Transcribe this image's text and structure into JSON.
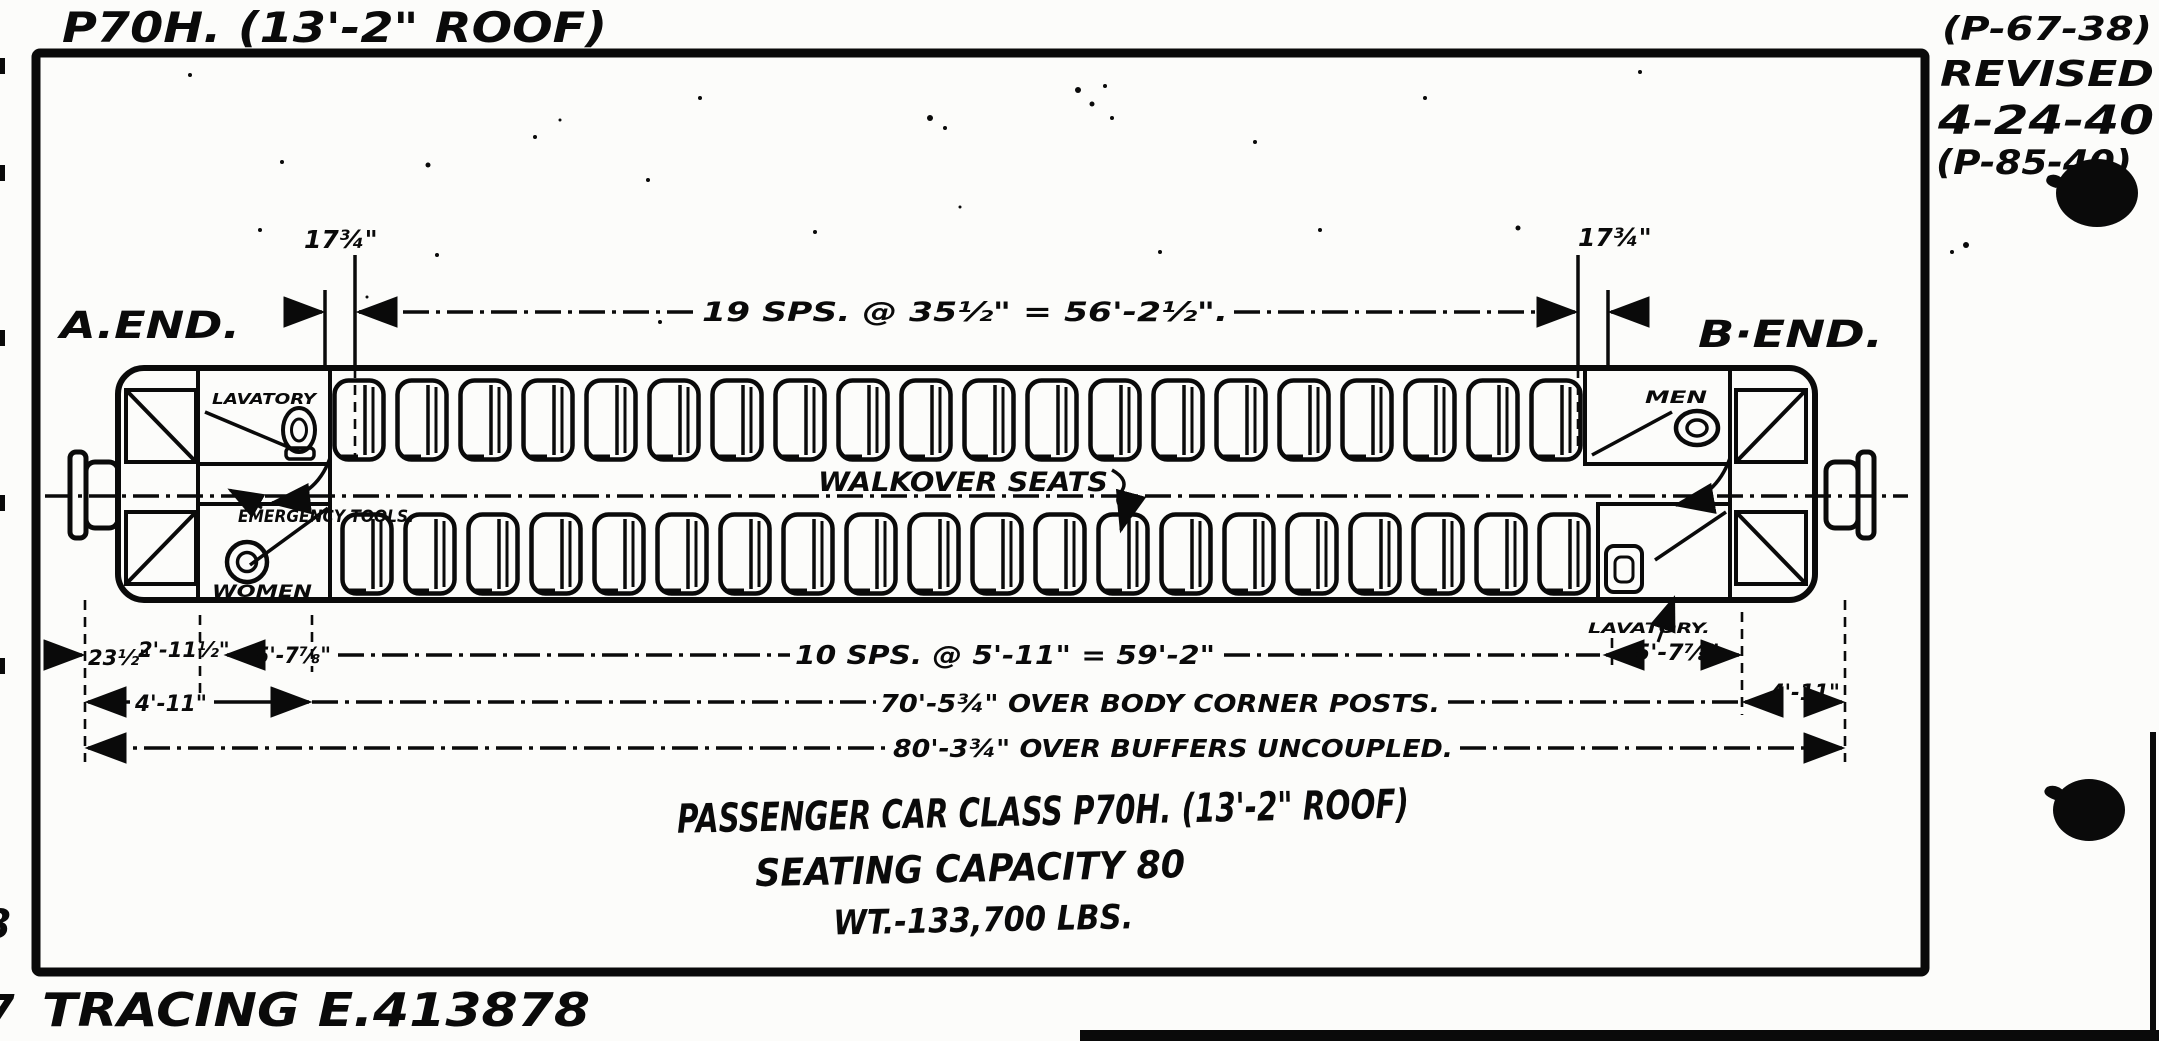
{
  "page": {
    "bg": "#fcfcfa",
    "ink": "#0a0a0a"
  },
  "header": {
    "note": "P70H. (13'-2\" ROOF)",
    "revision": {
      "ref": "(P-67-38)",
      "revised_label": "REVISED",
      "date": "4-24-40",
      "ref2": "(P-85-40)"
    }
  },
  "drawing": {
    "a_end_label": "A.END.",
    "b_end_label": "B·END.",
    "top_dim_left": "17¾\"",
    "top_dim_right": "17¾\"",
    "top_spacing_dim": "19 SPS. @ 35½\" = 56'-2½\".",
    "walkover_label": "WALKOVER SEATS",
    "emergency_label": "EMERGENCY TOOLS.",
    "rooms": {
      "lavatory_front": "LAVATORY",
      "women": "WOMEN",
      "men": "MEN",
      "lavatory_rear": "LAVATORY."
    },
    "seats": {
      "rows": 2,
      "per_row": 20
    },
    "dims": {
      "d23": "23½\"",
      "d211": "2'-11½\"",
      "d578_left": "5'-7⅞\"",
      "spacing": "10 SPS. @ 5'-11\" = 59'-2\"",
      "d578_right": "5'-7⅞\"",
      "d411_left": "4'-11\"",
      "body_posts": "70'-5¾\" OVER BODY CORNER POSTS.",
      "d411_right": "4'-11\"",
      "buffers": "80'-3¾\" OVER BUFFERS UNCOUPLED."
    }
  },
  "title_block": {
    "line1": "PASSENGER CAR CLASS P70H. (13'-2\" ROOF)",
    "line2": "SEATING CAPACITY 80",
    "line3": "WT.-133,700 LBS."
  },
  "footer": {
    "tracing": "TRACING E.413878"
  },
  "margin_fragments": {
    "left_mid": "8",
    "left_bottom": "7"
  }
}
